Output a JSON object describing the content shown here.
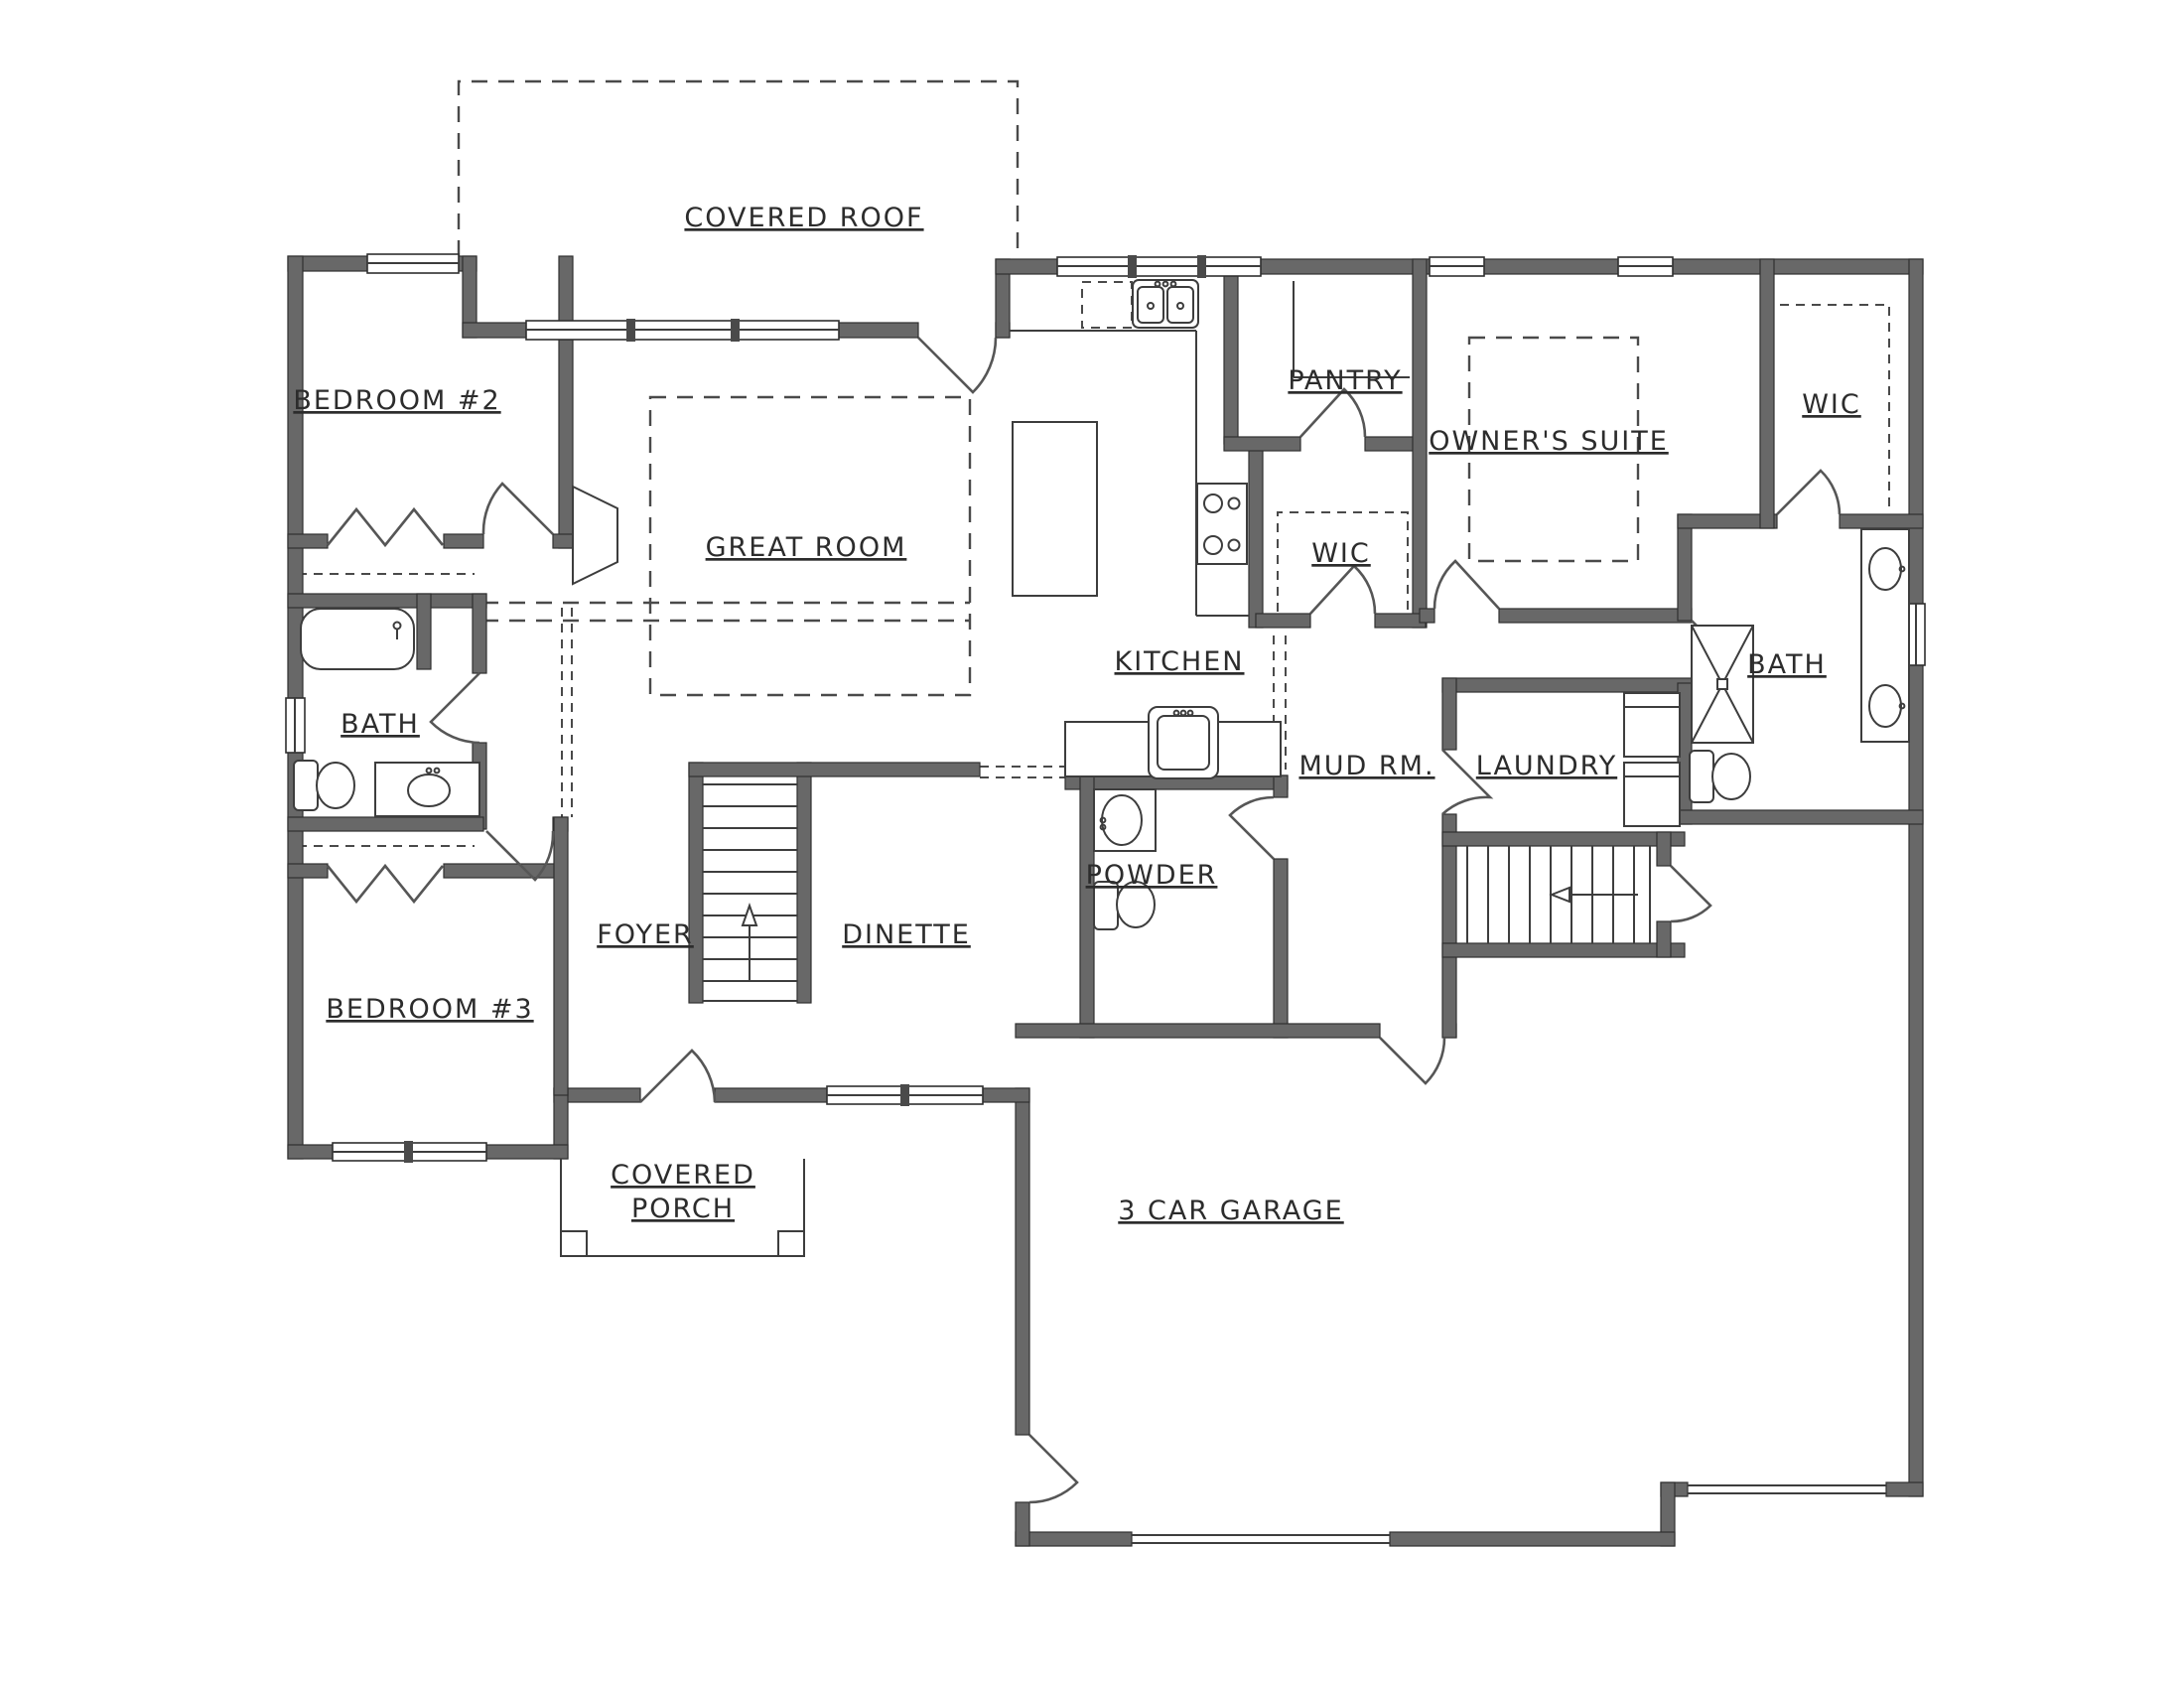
{
  "drawing": {
    "type": "residential floor plan",
    "wall_color": "#686868",
    "background": "#ffffff"
  },
  "rooms": {
    "covered_roof": {
      "label": "COVERED ROOF"
    },
    "bedroom_2": {
      "label": "BEDROOM #2"
    },
    "great_room": {
      "label": "GREAT ROOM"
    },
    "kitchen": {
      "label": "KITCHEN"
    },
    "pantry": {
      "label": "PANTRY"
    },
    "owners_suite": {
      "label": "OWNER'S SUITE"
    },
    "wic_master": {
      "label": "WIC"
    },
    "wic_hall": {
      "label": "WIC"
    },
    "bath_left": {
      "label": "BATH"
    },
    "bath_master": {
      "label": "BATH"
    },
    "mud_room": {
      "label": "MUD RM."
    },
    "laundry": {
      "label": "LAUNDRY"
    },
    "powder": {
      "label": "POWDER"
    },
    "foyer": {
      "label": "FOYER"
    },
    "dinette": {
      "label": "DINETTE"
    },
    "bedroom_3": {
      "label": "BEDROOM #3"
    },
    "covered_porch": {
      "label_line1": "COVERED",
      "label_line2": "PORCH"
    },
    "garage": {
      "label": "3 CAR GARAGE"
    }
  }
}
